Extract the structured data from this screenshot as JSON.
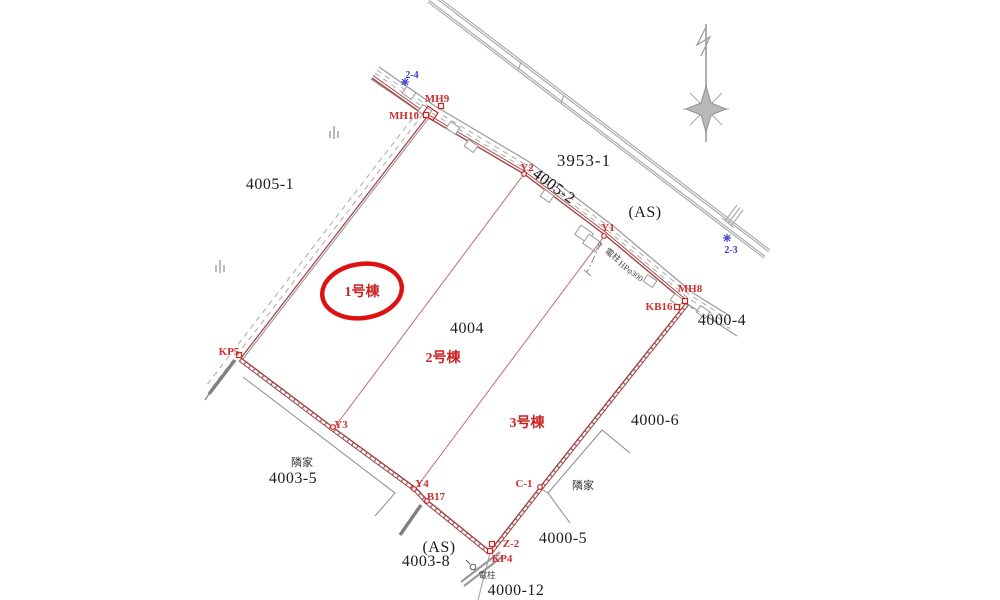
{
  "lots": {
    "l3953_1": "3953-1",
    "l4005_1": "4005-1",
    "l4005_2": "4005-2",
    "as_top": "(AS)",
    "l4004": "4004",
    "l4000_4": "4000-4",
    "l4000_6": "4000-6",
    "l4003_5": "4003-5",
    "l4000_5": "4000-5",
    "as_bottom": "(AS)",
    "l4003_8": "4003-8",
    "l4000_12": "4000-12"
  },
  "neighbors": {
    "left": "隣家",
    "right": "隣家"
  },
  "buildings": {
    "b1": "1号棟",
    "b2": "2号棟",
    "b3": "3号棟"
  },
  "points": {
    "mh9": "MH9",
    "mh10": "MH10",
    "y2": "Y2",
    "y1": "Y1",
    "mh8": "MH8",
    "kb16": "KB16",
    "kp5": "KP5",
    "y3": "Y3",
    "y4": "Y4",
    "b17": "B17",
    "c1": "C-1",
    "z2": "Z-2",
    "kp4": "KP4"
  },
  "bench_points": {
    "p24": "2-4",
    "p23": "2-3"
  },
  "utilities": {
    "pole_top": "電柱",
    "pipe": "HPφ300",
    "pole_bottom": "電柱"
  },
  "colors": {
    "boundary_red": "#9c4444",
    "division_red": "#c46a6a",
    "highlight_red": "#dd1111",
    "point_red": "#d03030",
    "road_gray": "#9a9a9a",
    "neighbor_gray": "#8a8a8a",
    "benchmark_blue": "#3a3ac8"
  }
}
